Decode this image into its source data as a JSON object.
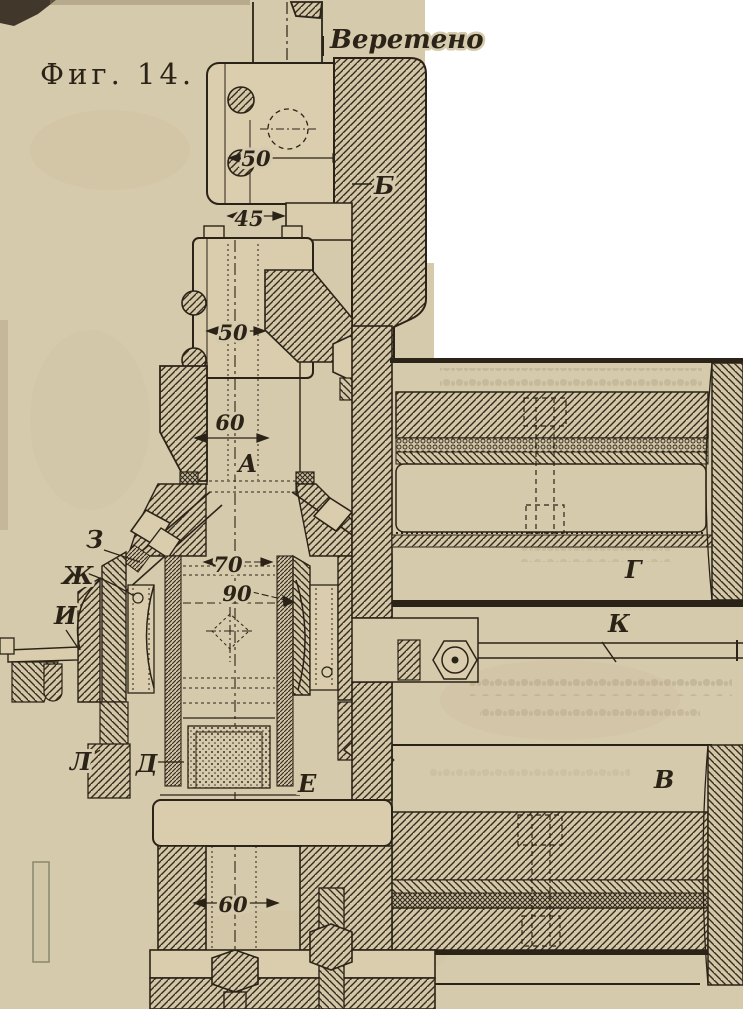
{
  "page": {
    "background_color": "#ffffff",
    "paper_color": "#d6caac",
    "ink_color": "#2b2317"
  },
  "figure": {
    "caption": "Фиг. 14.",
    "spindle_label": "Веретено",
    "part_labels": {
      "a": "А",
      "b": "Б",
      "v": "В",
      "g": "Г",
      "d": "Д",
      "e": "Е",
      "zh": "Ж",
      "z": "З",
      "i": "И",
      "k": "К",
      "l": "Л"
    },
    "dimensions": {
      "top_bore": "50",
      "neck": "45",
      "mid_bore": "50",
      "quill": "60",
      "gear_bore": "70",
      "gear_od": "90",
      "bottom_bore": "60"
    }
  }
}
